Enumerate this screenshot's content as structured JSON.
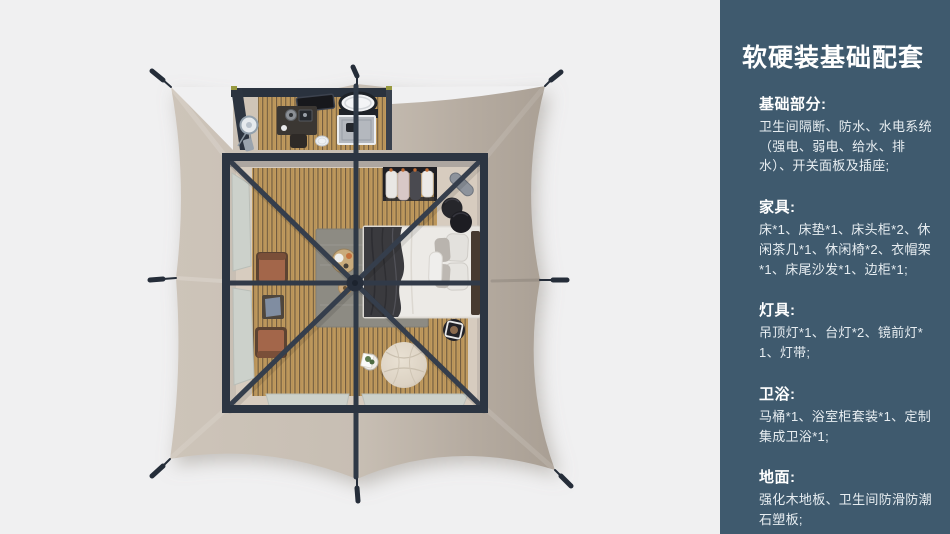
{
  "sidebar": {
    "background": "#3f5a6e",
    "title": "软硬装基础配套",
    "sections": [
      {
        "heading": "基础部分:",
        "body": "卫生间隔断、防水、水电系统（强电、弱电、给水、排水）、开关面板及插座;"
      },
      {
        "heading": "家具:",
        "body": "床*1、床垫*1、床头柜*2、休闲茶几*1、休闲椅*2、衣帽架*1、床尾沙发*1、边柜*1;"
      },
      {
        "heading": "灯具:",
        "body": "吊顶灯*1、台灯*2、镜前灯*1、灯带;"
      },
      {
        "heading": "卫浴:",
        "body": "马桶*1、浴室柜套装*1、定制集成卫浴*1;"
      },
      {
        "heading": "地面:",
        "body": "强化木地板、卫生间防滑防潮石塑板;"
      }
    ]
  },
  "floorplan": {
    "label": "tent-top-view",
    "rooms": [
      "bedroom",
      "bathroom"
    ],
    "colors": {
      "background": "#f0f0f1",
      "canvas_light": "#cdc4b9",
      "canvas_dark": "#a99f94",
      "frame": "#2c3542",
      "wood_floor": "#c09a5e",
      "rug": "#8d8b83",
      "bedding": "#eceae6",
      "blanket": "#3a3a3e",
      "leather_chair": "#a3664a",
      "pouf": "#ddd3c4",
      "window": "#ccd1cb"
    }
  }
}
